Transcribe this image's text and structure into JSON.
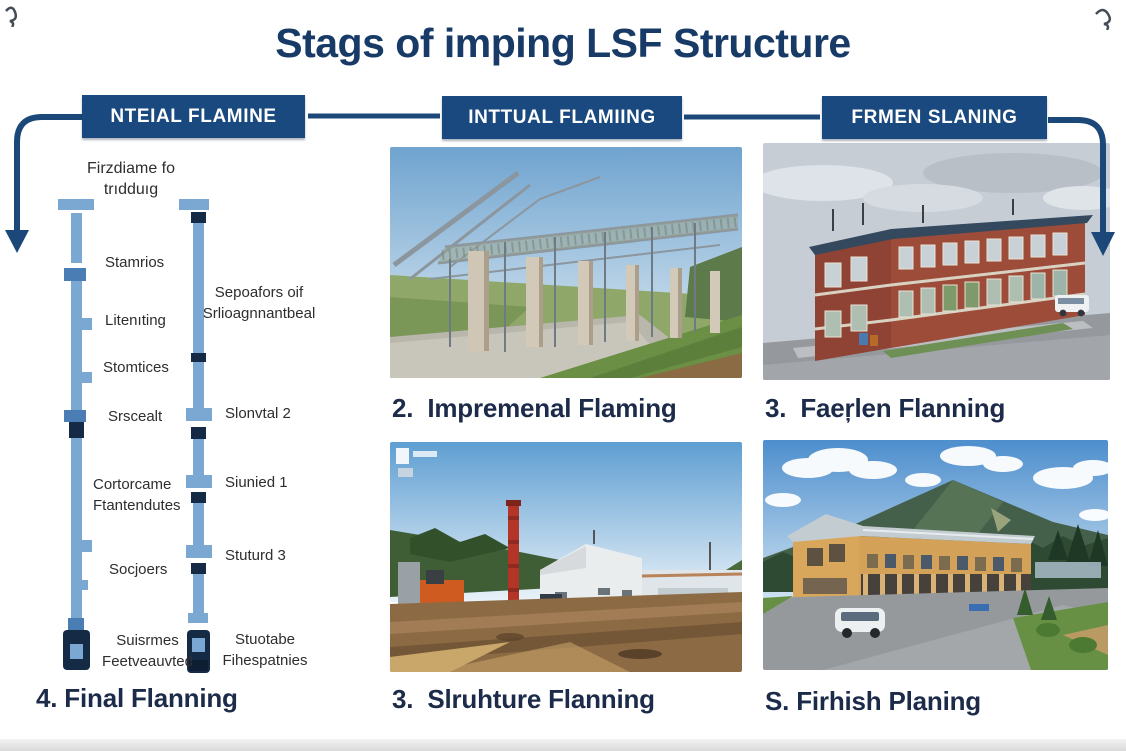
{
  "title": "Stags of imping LSF Structure",
  "headers": {
    "h1": "NTEIAL FLAMINE",
    "h2": "INTTUAL FLAMIING",
    "h3": "FRMEN SLANING"
  },
  "diagram": {
    "top1": "Firzdiame fo",
    "top2": "trıdduıg",
    "l1": "Stamrios",
    "l2": "Litenıting",
    "l3": "Stomtices",
    "l4": "Srscealt",
    "l5a": "Cortorcame",
    "l5b": "Ftantendutes",
    "l6": "Socjoers",
    "l7a": "Suisrmes",
    "l7b": "Feetveauvted",
    "r1a": "Sepoafors oif",
    "r1b": "Srlioagnnantbeal",
    "r2": "Slonvtal 2",
    "r3": "Siunied 1",
    "r4": "Stuturd 3",
    "r5a": "Stuotabe",
    "r5b": "Fihespatnies"
  },
  "captions": {
    "stage2": "2.  Impremenal Flaming",
    "stage3_top": "3.  Faeŗlen Flanning",
    "stage4": "4. Final Flanning",
    "stage3_bottom": "3.  Slruhture Flanning",
    "stage5": "S. Firhish Planing"
  },
  "photos": {
    "top_middle": "steel-frame-skeleton",
    "top_right": "red-brick-building",
    "bottom_middle": "construction-site",
    "bottom_right": "finished-timber-building"
  },
  "colors": {
    "header_bg": "#19497E",
    "title_text": "#173A66",
    "caption_text": "#1C2B4A",
    "arrow": "#1B4878",
    "bar_light": "#7BA7D3",
    "bar_mid": "#4A7DB3",
    "bar_dark": "#152B45"
  }
}
